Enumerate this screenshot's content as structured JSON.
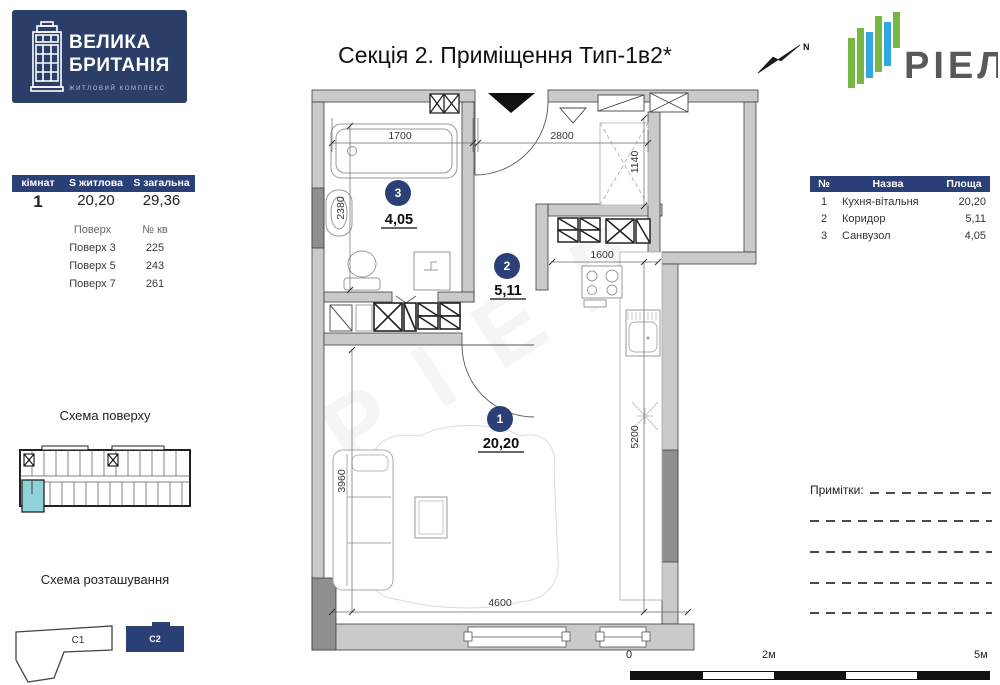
{
  "branding": {
    "logo_line1": "ВЕЛИКА",
    "logo_line2": "БРИТАНІЯ",
    "logo_subtitle": "ЖИТЛОВИЙ КОМПЛЕКС",
    "developer": "РІЕЛ",
    "north_label": "N",
    "watermark": "РІЕЛ"
  },
  "title": "Секція 2. Приміщення Тип-1в2*",
  "summary": {
    "headers": [
      "кімнат",
      "S житлова",
      "S загальна"
    ],
    "rooms_count": "1",
    "living_area": "20,20",
    "total_area": "29,36",
    "floors_header": {
      "floor": "Поверх",
      "apt": "№ кв"
    },
    "floors": [
      {
        "floor": "Поверх 3",
        "apt": "225"
      },
      {
        "floor": "Поверх 5",
        "apt": "243"
      },
      {
        "floor": "Поверх 7",
        "apt": "261"
      }
    ]
  },
  "floor_schema_title": "Схема поверху",
  "location_schema": {
    "title": "Схема розташування",
    "c1": "C1",
    "c2": "C2"
  },
  "rooms_table": {
    "headers": [
      "№",
      "Назва",
      "Площа"
    ],
    "rows": [
      {
        "num": "1",
        "name": "Кухня-вітальня",
        "area": "20,20"
      },
      {
        "num": "2",
        "name": "Коридор",
        "area": "5,11"
      },
      {
        "num": "3",
        "name": "Санвузол",
        "area": "4,05"
      }
    ]
  },
  "notes_label": "Примітки:",
  "scale_bar": {
    "zero": "0",
    "mid": "2м",
    "end": "5м"
  },
  "plan": {
    "badges": [
      {
        "num": "1",
        "area": "20,20"
      },
      {
        "num": "2",
        "area": "5,11"
      },
      {
        "num": "3",
        "area": "4,05"
      }
    ],
    "dims": {
      "d1700": "1700",
      "d2800": "2800",
      "d1140": "1140",
      "d2380": "2380",
      "d1600": "1600",
      "d3960": "3960",
      "d5200": "5200",
      "d4600": "4600"
    }
  },
  "colors": {
    "navy": "#2a4076",
    "logo_navy": "#2b3e68",
    "wall": "#cacaca",
    "wall_dark": "#8f8f8f",
    "highlight": "#8fd3da",
    "riel_green": "#76b843",
    "riel_blue": "#31a8df",
    "riel_text": "#58595b"
  }
}
